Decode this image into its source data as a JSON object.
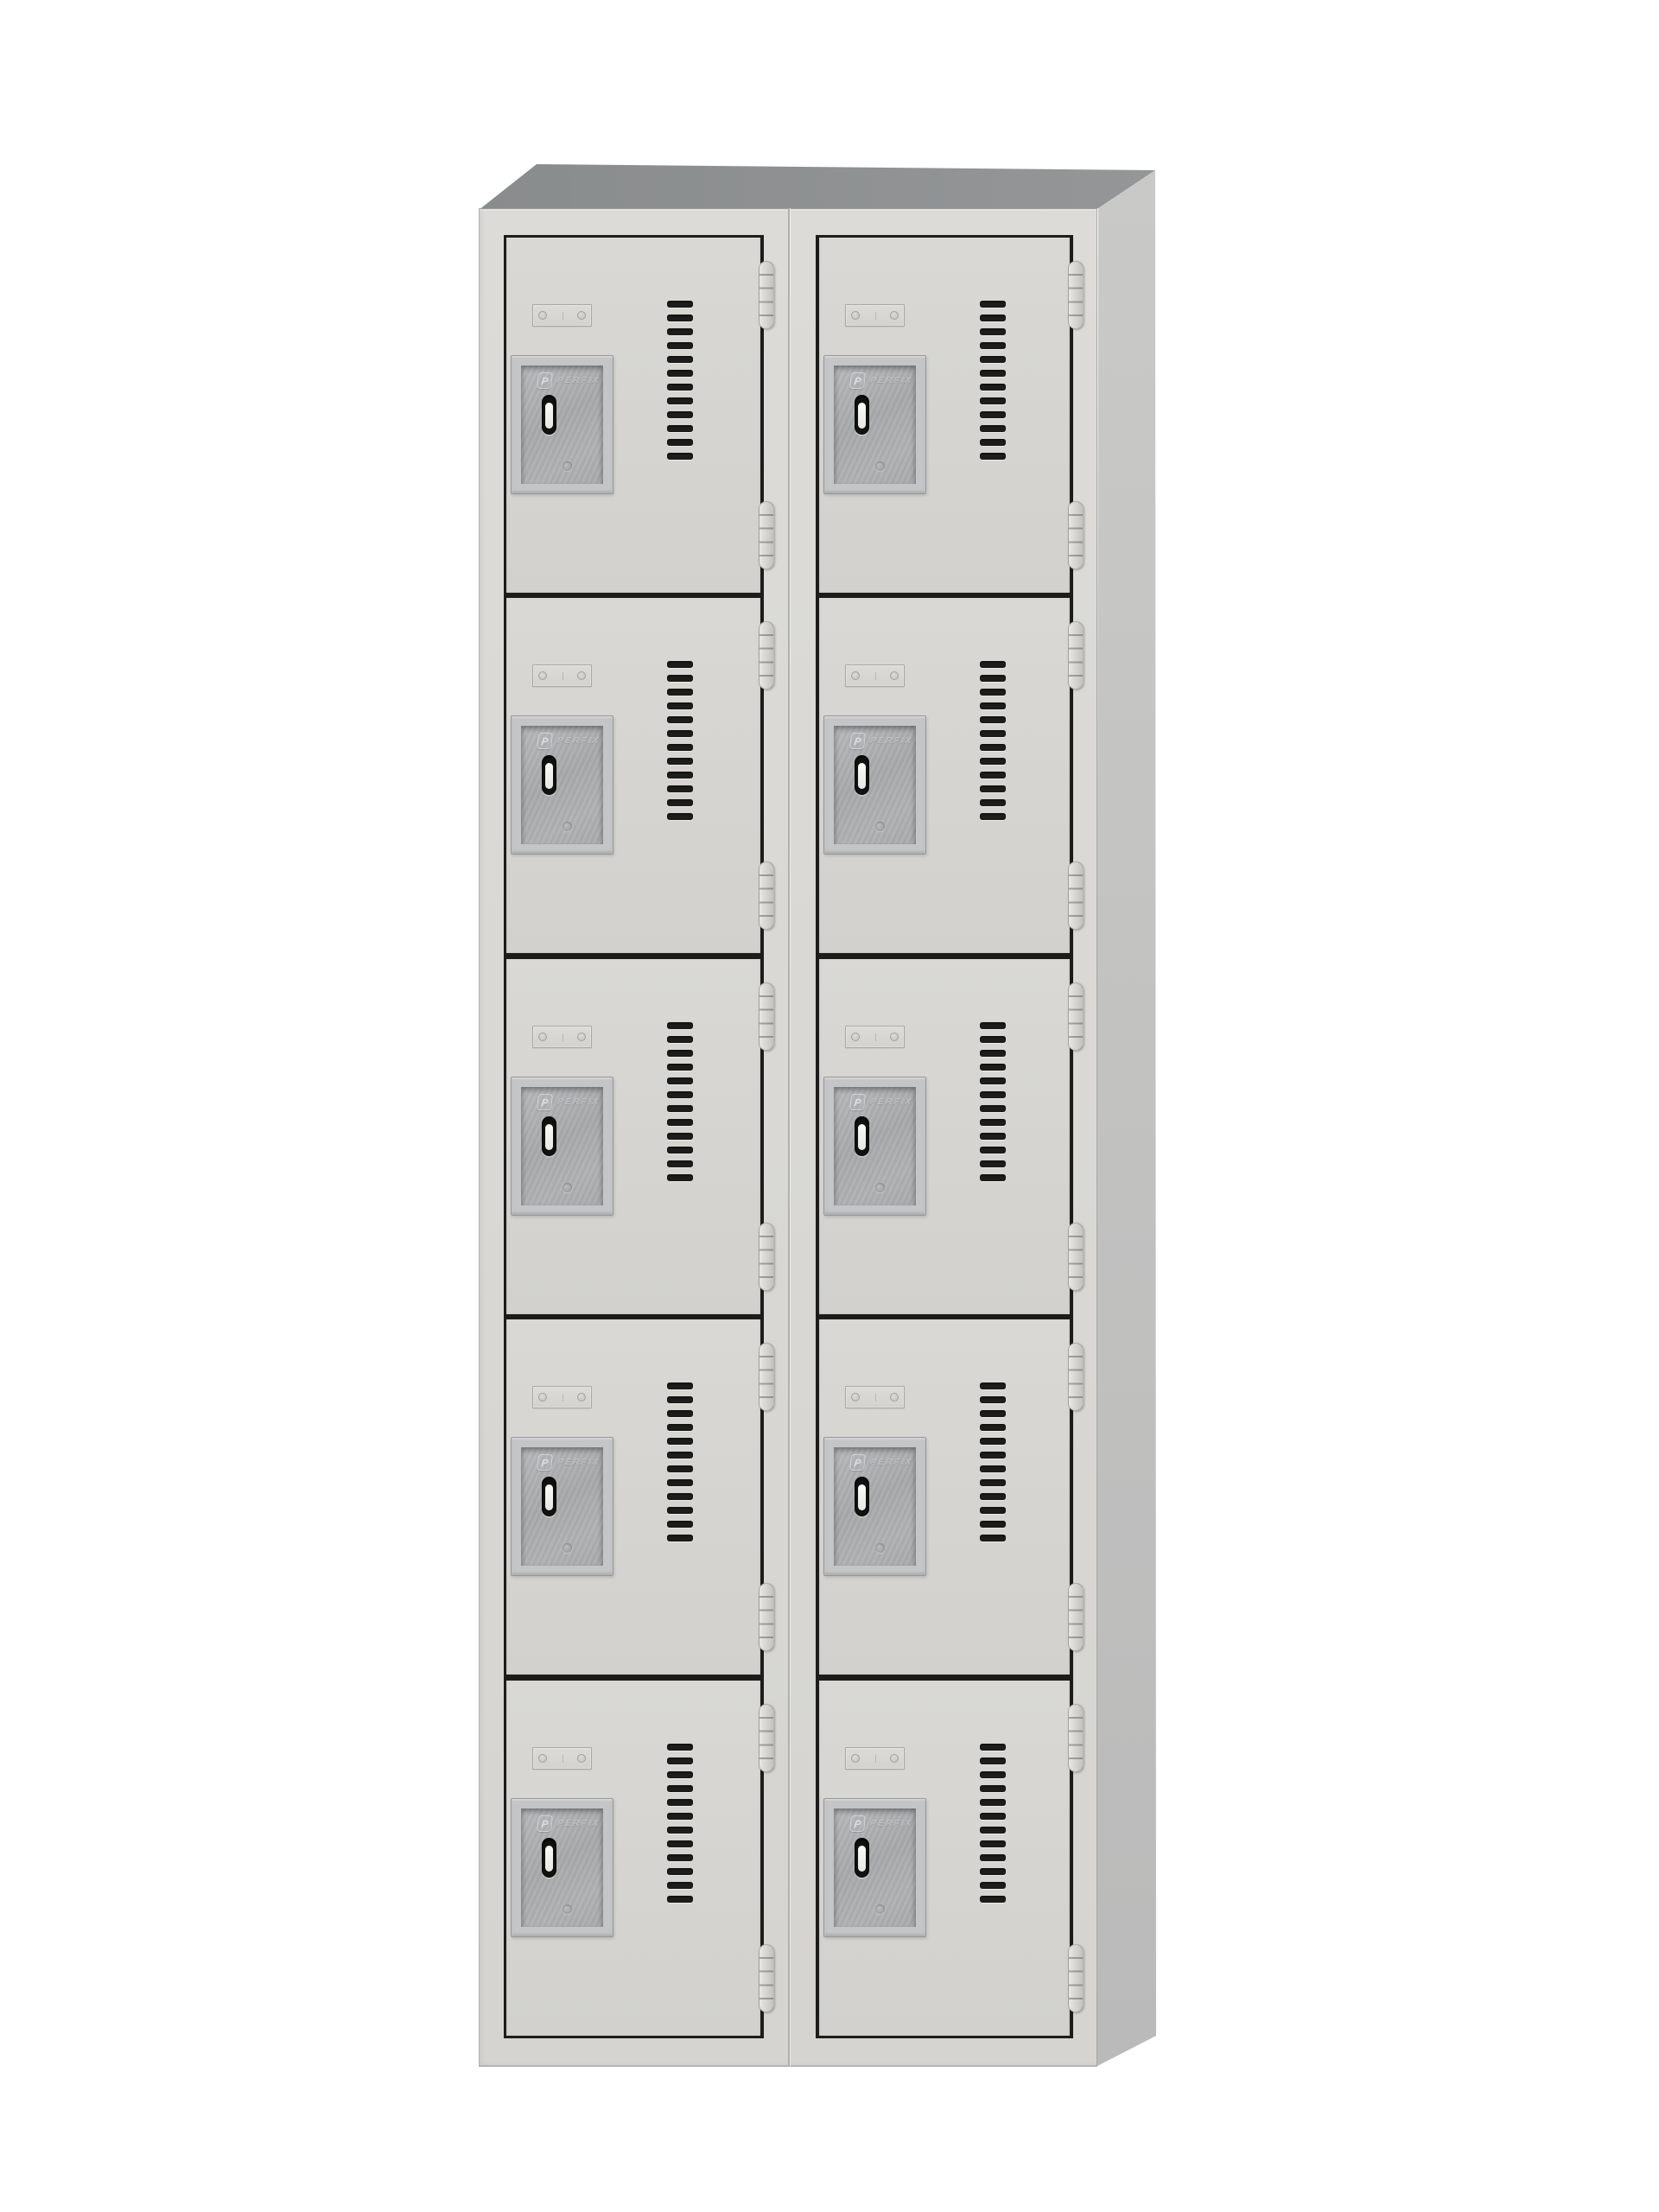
{
  "product": {
    "type": "box-locker-cabinet",
    "description": "Two-column ten-door gray steel box locker, angled product render on white background",
    "columns": 2,
    "rows": 5,
    "brand_plate": {
      "monogram": "P",
      "brand_text": "PERFIX"
    },
    "compartments": [
      {
        "id": "L1",
        "column": 0,
        "row": 0
      },
      {
        "id": "L2",
        "column": 0,
        "row": 1
      },
      {
        "id": "L3",
        "column": 0,
        "row": 2
      },
      {
        "id": "L4",
        "column": 0,
        "row": 3
      },
      {
        "id": "L5",
        "column": 0,
        "row": 4
      },
      {
        "id": "R1",
        "column": 1,
        "row": 0
      },
      {
        "id": "R2",
        "column": 1,
        "row": 1
      },
      {
        "id": "R3",
        "column": 1,
        "row": 2
      },
      {
        "id": "R4",
        "column": 1,
        "row": 3
      },
      {
        "id": "R5",
        "column": 1,
        "row": 4
      }
    ],
    "door_features": {
      "name_plate_screw_count": 2,
      "vent_slot_count": 12,
      "hinge_count": 2,
      "hinge_knuckle_count": 5
    }
  },
  "colors": {
    "background": "#ffffff",
    "frame": "#dcdbd7",
    "door_top": "#d9d8d4",
    "door_bottom": "#d2d1cd",
    "top_face_dark": "#898c8d",
    "top_face_light": "#949697",
    "side_face_top": "#c9c9c7",
    "side_face_bottom": "#bababa",
    "gap_line": "#1c1c1a",
    "vent_slot": "#1d1d1b",
    "latch_bevel": "#c3c5c7",
    "latch_face": "#a9abad",
    "handle_slot": "#131311",
    "handle_insert": "#e6e6e4",
    "hinge": "#d9d8d4"
  }
}
